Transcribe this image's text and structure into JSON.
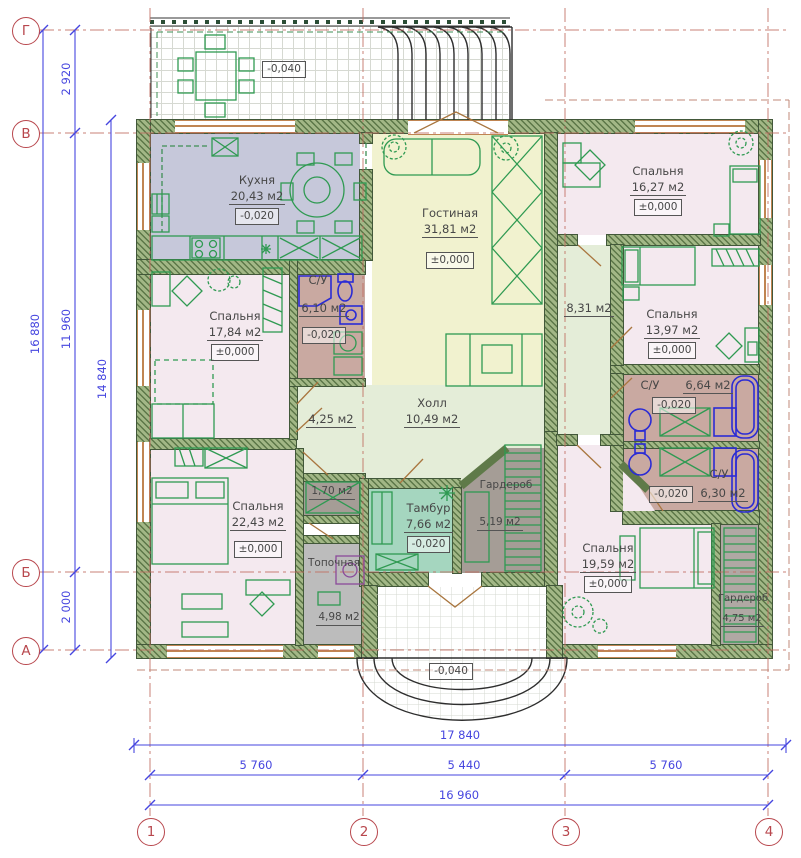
{
  "axes": {
    "rows": [
      "Г",
      "В",
      "Б",
      "А"
    ],
    "cols": [
      "1",
      "2",
      "3",
      "4"
    ]
  },
  "dims": {
    "left_overall": "16 880",
    "left_seg_top": "2 920",
    "left_seg_mid": "11 960",
    "left_seg_bot": "2 000",
    "left_inner": "14 840",
    "bottom_overall": "17 840",
    "bottom_seg_1": "5 760",
    "bottom_seg_2": "5 440",
    "bottom_seg_3": "5 760",
    "bottom_inner": "16 960"
  },
  "marks": {
    "terrace": "-0,040",
    "porch": "-0,040"
  },
  "rooms": {
    "kitchen": {
      "name": "Кухня",
      "area": "20,43 м2",
      "elev": "-0,020"
    },
    "living": {
      "name": "Гостиная",
      "area": "31,81 м2",
      "elev": "±0,000"
    },
    "bedroom_ne": {
      "name": "Спальня",
      "area": "16,27 м2",
      "elev": "±0,000"
    },
    "bedroom_w": {
      "name": "Спальня",
      "area": "17,84 м2",
      "elev": "±0,000"
    },
    "bath_w": {
      "name": "С/У",
      "area": "6,10 м2",
      "elev": "-0,020"
    },
    "corridor_e": {
      "area": "8,31 м2"
    },
    "bedroom_e": {
      "name": "Спальня",
      "area": "13,97 м2",
      "elev": "±0,000"
    },
    "bath_e_top": {
      "name": "С/У",
      "area": "6,64 м2",
      "elev": "-0,020"
    },
    "bath_e_bot": {
      "name": "С/У",
      "area": "6,30 м2",
      "elev": "-0,020"
    },
    "hall": {
      "name": "Холл",
      "area": "10,49 м2"
    },
    "corridor_w": {
      "area": "4,25 м2"
    },
    "closet": {
      "area": "1,70 м2"
    },
    "tambour": {
      "name": "Тамбур",
      "area": "7,66 м2",
      "elev": "-0,020"
    },
    "wardrobe_c": {
      "name": "Гардероб",
      "area": "5,19 м2"
    },
    "bedroom_sw": {
      "name": "Спальня",
      "area": "22,43 м2",
      "elev": "±0,000"
    },
    "boiler": {
      "name": "Топочная",
      "area": "4,98 м2"
    },
    "bedroom_se": {
      "name": "Спальня",
      "area": "19,59 м2",
      "elev": "±0,000"
    },
    "wardrobe_se": {
      "name": "Гардероб",
      "area": "4,75 м2"
    }
  }
}
